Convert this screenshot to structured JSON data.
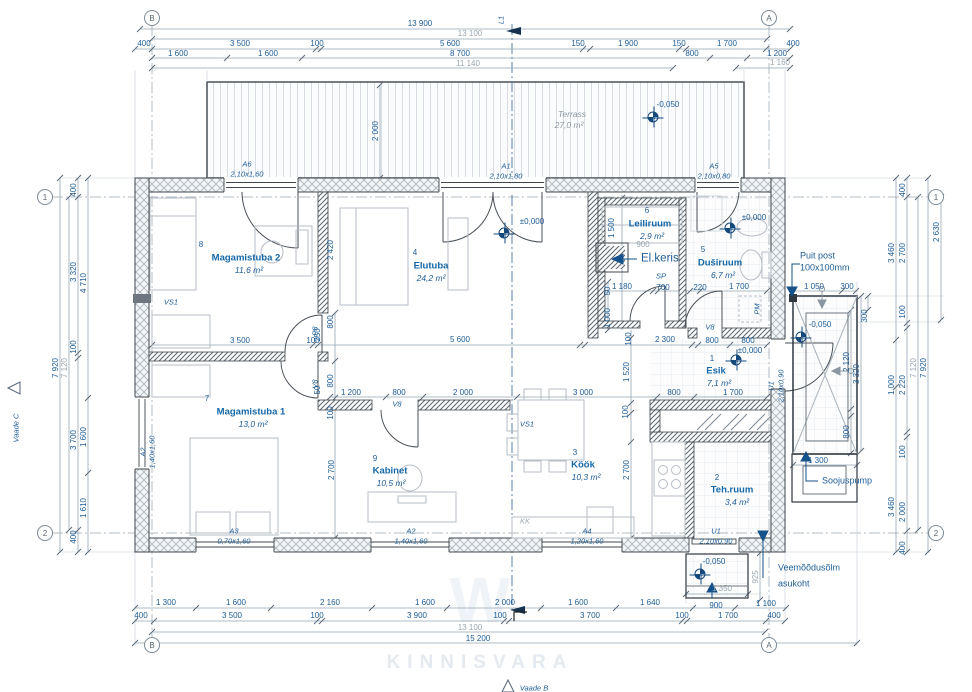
{
  "drawing": {
    "watermark": "KINNISVARA",
    "brand_mark": "W",
    "view_bottom": "Vaade B",
    "view_left": "Vaade C",
    "section_label": "L1"
  },
  "grid_markers": [
    {
      "t": "B",
      "x": 152,
      "y": 18
    },
    {
      "t": "A",
      "x": 769,
      "y": 18
    },
    {
      "t": "B",
      "x": 152,
      "y": 645
    },
    {
      "t": "A",
      "x": 769,
      "y": 645
    },
    {
      "t": "1",
      "x": 45,
      "y": 197
    },
    {
      "t": "2",
      "x": 45,
      "y": 533
    },
    {
      "t": "1",
      "x": 936,
      "y": 197
    },
    {
      "t": "2",
      "x": 936,
      "y": 533
    }
  ],
  "rooms": [
    {
      "num": "",
      "g": 1,
      "name": "Terrass",
      "x": 572,
      "y": 114,
      "area": "27,0 m²",
      "ax": 569,
      "ay": 125
    },
    {
      "num": "8",
      "nx": 201,
      "ny": 245,
      "name": "Magamistuba 2",
      "x": 246,
      "y": 258,
      "area": "11,6 m²",
      "ax": 249,
      "ay": 270
    },
    {
      "num": "4",
      "nx": 415,
      "ny": 253,
      "name": "Elutuba",
      "x": 431,
      "y": 266,
      "area": "24,2 m²",
      "ax": 431,
      "ay": 278
    },
    {
      "num": "6",
      "nx": 647,
      "ny": 211,
      "name": "Leiliruum",
      "x": 650,
      "y": 224,
      "area": "2,9 m²",
      "ax": 652,
      "ay": 236
    },
    {
      "num": "5",
      "nx": 703,
      "ny": 250,
      "name": "Duširuum",
      "x": 720,
      "y": 263,
      "area": "6,7 m²",
      "ax": 723,
      "ay": 275
    },
    {
      "num": "1",
      "nx": 712,
      "ny": 359,
      "name": "Esik",
      "x": 716,
      "y": 371,
      "area": "7,1 m²",
      "ax": 719,
      "ay": 383
    },
    {
      "num": "7",
      "nx": 207,
      "ny": 399,
      "name": "Magamistuba 1",
      "x": 251,
      "y": 412,
      "area": "13,0 m²",
      "ax": 253,
      "ay": 424
    },
    {
      "num": "9",
      "nx": 375,
      "ny": 459,
      "name": "Kabinet",
      "x": 390,
      "y": 471,
      "area": "10,5 m²",
      "ax": 391,
      "ay": 483
    },
    {
      "num": "3",
      "nx": 575,
      "ny": 453,
      "name": "Köök",
      "x": 583,
      "y": 465,
      "area": "10,3 m²",
      "ax": 586,
      "ay": 477
    },
    {
      "num": "2",
      "nx": 717,
      "ny": 478,
      "name": "Teh.ruum",
      "x": 732,
      "y": 490,
      "area": "3,4 m²",
      "ax": 737,
      "ay": 502
    }
  ],
  "openings": [
    {
      "code": "A6",
      "cx": 247,
      "cy": 164,
      "size": "2,10x1,60",
      "sx": 247,
      "sy": 174
    },
    {
      "code": "A1",
      "cx": 506,
      "cy": 166,
      "size": "2,10x1,80",
      "sx": 506,
      "sy": 176
    },
    {
      "code": "A5",
      "cx": 714,
      "cy": 166,
      "size": "2,10x0,80",
      "sx": 714,
      "sy": 176
    },
    {
      "code": "A3",
      "cx": 234,
      "cy": 531,
      "size": "0,70x1,60",
      "sx": 234,
      "sy": 541
    },
    {
      "code": "A2",
      "cx": 411,
      "cy": 531,
      "size": "1,40x1,60",
      "sx": 411,
      "sy": 541
    },
    {
      "code": "A4",
      "cx": 587,
      "cy": 531,
      "size": "1,20x1,60",
      "sx": 587,
      "sy": 541
    },
    {
      "code": "U1",
      "cx": 716,
      "cy": 531,
      "size": "2,10x0,90",
      "sx": 716,
      "sy": 541
    },
    {
      "code": "U1",
      "cx": 771,
      "cy": 386,
      "size": "2,10x0,90",
      "sx": 781,
      "sy": 386,
      "rot": 1
    },
    {
      "code": "A2",
      "cx": 143,
      "cy": 452,
      "size": "1,40x1,60",
      "sx": 152,
      "sy": 452,
      "rot": 1
    }
  ],
  "tags": [
    {
      "t": "P8",
      "x": 315,
      "y": 331,
      "rot": 1
    },
    {
      "t": "V8",
      "x": 315,
      "y": 384,
      "rot": 1
    },
    {
      "t": "V8",
      "x": 397,
      "y": 404
    },
    {
      "t": "V8",
      "x": 710,
      "y": 327
    },
    {
      "t": "SP",
      "x": 661,
      "y": 276
    },
    {
      "t": "VS1",
      "x": 171,
      "y": 302
    },
    {
      "t": "VS1",
      "x": 527,
      "y": 424
    },
    {
      "t": "PM",
      "x": 757,
      "y": 309,
      "rot": 1
    },
    {
      "t": "KK",
      "x": 525,
      "y": 521,
      "m": 1
    },
    {
      "t": "L1",
      "x": 501,
      "y": 20,
      "rot": 1
    }
  ],
  "levels": [
    {
      "t": "-0,050",
      "x": 668,
      "y": 105,
      "mx": 653,
      "my": 117
    },
    {
      "t": "±0,000",
      "x": 532,
      "y": 222,
      "mx": 504,
      "my": 233
    },
    {
      "t": "±0,000",
      "x": 754,
      "y": 218,
      "mx": 730,
      "my": 228
    },
    {
      "t": "±0,000",
      "x": 750,
      "y": 351,
      "mx": 736,
      "my": 360
    },
    {
      "t": "-0,050",
      "x": 820,
      "y": 325,
      "mx": 801,
      "my": 337
    },
    {
      "t": "-0,050",
      "x": 714,
      "y": 562,
      "mx": 700,
      "my": 574
    }
  ],
  "notes": [
    {
      "t": "Puit post",
      "x": 800,
      "y": 256
    },
    {
      "t": "100x100mm",
      "x": 800,
      "y": 268
    },
    {
      "t": "El.keris",
      "x": 641,
      "y": 259,
      "big": 1
    },
    {
      "t": "Soojuspump",
      "x": 822,
      "y": 481
    },
    {
      "t": "Veemõõdusõlm",
      "x": 778,
      "y": 568
    },
    {
      "t": "asukoht",
      "x": 778,
      "y": 584
    }
  ],
  "dims": [
    {
      "t": "13 900",
      "x": 420,
      "y": 24
    },
    {
      "t": "13 100",
      "x": 470,
      "y": 34,
      "m": 1
    },
    {
      "t": "400",
      "x": 144,
      "y": 44
    },
    {
      "t": "3 500",
      "x": 240,
      "y": 44
    },
    {
      "t": "100",
      "x": 317,
      "y": 44
    },
    {
      "t": "5 600",
      "x": 450,
      "y": 44
    },
    {
      "t": "150",
      "x": 578,
      "y": 44
    },
    {
      "t": "1 900",
      "x": 628,
      "y": 44
    },
    {
      "t": "150",
      "x": 679,
      "y": 44
    },
    {
      "t": "1 700",
      "x": 727,
      "y": 44
    },
    {
      "t": "400",
      "x": 793,
      "y": 44
    },
    {
      "t": "1 600",
      "x": 178,
      "y": 54
    },
    {
      "t": "1 600",
      "x": 268,
      "y": 54
    },
    {
      "t": "8 700",
      "x": 460,
      "y": 54
    },
    {
      "t": "800",
      "x": 692,
      "y": 54
    },
    {
      "t": "1 200",
      "x": 777,
      "y": 54
    },
    {
      "t": "11 140",
      "x": 468,
      "y": 64,
      "m": 1
    },
    {
      "t": "1 160",
      "x": 780,
      "y": 63,
      "m": 1
    },
    {
      "t": "1 300",
      "x": 166,
      "y": 603
    },
    {
      "t": "1 600",
      "x": 236,
      "y": 603
    },
    {
      "t": "2 160",
      "x": 330,
      "y": 603
    },
    {
      "t": "1 600",
      "x": 425,
      "y": 603
    },
    {
      "t": "2 000",
      "x": 505,
      "y": 603
    },
    {
      "t": "1 600",
      "x": 578,
      "y": 603
    },
    {
      "t": "1 640",
      "x": 650,
      "y": 603
    },
    {
      "t": "1 350",
      "x": 722,
      "y": 589,
      "m": 1
    },
    {
      "t": "900",
      "x": 716,
      "y": 606
    },
    {
      "t": "1 100",
      "x": 766,
      "y": 604
    },
    {
      "t": "400",
      "x": 141,
      "y": 616
    },
    {
      "t": "3 500",
      "x": 232,
      "y": 616
    },
    {
      "t": "100",
      "x": 317,
      "y": 616
    },
    {
      "t": "3 900",
      "x": 417,
      "y": 616
    },
    {
      "t": "100",
      "x": 500,
      "y": 616
    },
    {
      "t": "3 700",
      "x": 590,
      "y": 616
    },
    {
      "t": "100",
      "x": 682,
      "y": 616
    },
    {
      "t": "1 700",
      "x": 728,
      "y": 616
    },
    {
      "t": "400",
      "x": 774,
      "y": 616
    },
    {
      "t": "13 100",
      "x": 470,
      "y": 628,
      "m": 1
    },
    {
      "t": "15 200",
      "x": 478,
      "y": 639
    },
    {
      "t": "7 920",
      "x": 56,
      "y": 368,
      "r": 1
    },
    {
      "t": "7 120",
      "x": 65,
      "y": 368,
      "r": 1,
      "m": 1
    },
    {
      "t": "400",
      "x": 74,
      "y": 190,
      "r": 1
    },
    {
      "t": "3 320",
      "x": 74,
      "y": 272,
      "r": 1
    },
    {
      "t": "100",
      "x": 74,
      "y": 347,
      "r": 1
    },
    {
      "t": "3 700",
      "x": 74,
      "y": 440,
      "r": 1
    },
    {
      "t": "400",
      "x": 74,
      "y": 537,
      "r": 1
    },
    {
      "t": "4 710",
      "x": 84,
      "y": 283,
      "r": 1
    },
    {
      "t": "1 600",
      "x": 84,
      "y": 437,
      "r": 1
    },
    {
      "t": "1 610",
      "x": 84,
      "y": 508,
      "r": 1
    },
    {
      "t": "3 460",
      "x": 892,
      "y": 253,
      "r": 1
    },
    {
      "t": "1 000",
      "x": 892,
      "y": 385,
      "r": 1
    },
    {
      "t": "3 460",
      "x": 892,
      "y": 507,
      "r": 1
    },
    {
      "t": "400",
      "x": 903,
      "y": 190,
      "r": 1
    },
    {
      "t": "2 700",
      "x": 903,
      "y": 253,
      "r": 1
    },
    {
      "t": "100",
      "x": 903,
      "y": 312,
      "r": 1
    },
    {
      "t": "2 220",
      "x": 903,
      "y": 385,
      "r": 1
    },
    {
      "t": "100",
      "x": 903,
      "y": 452,
      "r": 1
    },
    {
      "t": "2 000",
      "x": 903,
      "y": 512,
      "r": 1
    },
    {
      "t": "400",
      "x": 903,
      "y": 548,
      "r": 1
    },
    {
      "t": "7 120",
      "x": 914,
      "y": 368,
      "r": 1,
      "m": 1
    },
    {
      "t": "7 920",
      "x": 924,
      "y": 368,
      "r": 1
    },
    {
      "t": "2 630",
      "x": 937,
      "y": 232,
      "r": 1
    },
    {
      "t": "1 050",
      "x": 814,
      "y": 287
    },
    {
      "t": "300",
      "x": 847,
      "y": 287
    },
    {
      "t": "300",
      "x": 865,
      "y": 316,
      "r": 1
    },
    {
      "t": "2 120",
      "x": 847,
      "y": 362,
      "r": 1
    },
    {
      "t": "3 320",
      "x": 857,
      "y": 374,
      "r": 1
    },
    {
      "t": "800",
      "x": 847,
      "y": 432,
      "r": 1
    },
    {
      "t": "1 300",
      "x": 818,
      "y": 461
    },
    {
      "t": "925",
      "x": 756,
      "y": 577,
      "r": 1,
      "m": 1
    },
    {
      "t": "2 000",
      "x": 376,
      "y": 131,
      "r": 1
    },
    {
      "t": "2 420",
      "x": 331,
      "y": 250,
      "r": 1
    },
    {
      "t": "3 500",
      "x": 240,
      "y": 341
    },
    {
      "t": "100",
      "x": 313,
      "y": 341
    },
    {
      "t": "5 600",
      "x": 460,
      "y": 340
    },
    {
      "t": "100",
      "x": 629,
      "y": 339,
      "r": 1
    },
    {
      "t": "2 300",
      "x": 665,
      "y": 340
    },
    {
      "t": "800",
      "x": 712,
      "y": 341
    },
    {
      "t": "800",
      "x": 748,
      "y": 341
    },
    {
      "t": "250",
      "x": 318,
      "y": 335,
      "r": 1
    },
    {
      "t": "800",
      "x": 331,
      "y": 322,
      "r": 1
    },
    {
      "t": "50",
      "x": 318,
      "y": 390,
      "r": 1
    },
    {
      "t": "800",
      "x": 331,
      "y": 381,
      "r": 1
    },
    {
      "t": "100",
      "x": 331,
      "y": 413,
      "r": 1
    },
    {
      "t": "2 700",
      "x": 332,
      "y": 470,
      "r": 1
    },
    {
      "t": "1 200",
      "x": 351,
      "y": 393
    },
    {
      "t": "800",
      "x": 399,
      "y": 393
    },
    {
      "t": "2 000",
      "x": 463,
      "y": 393
    },
    {
      "t": "3 000",
      "x": 583,
      "y": 393
    },
    {
      "t": "800",
      "x": 674,
      "y": 393
    },
    {
      "t": "1 700",
      "x": 733,
      "y": 393
    },
    {
      "t": "100",
      "x": 626,
      "y": 412,
      "r": 1
    },
    {
      "t": "2 700",
      "x": 627,
      "y": 470,
      "r": 1
    },
    {
      "t": "1 520",
      "x": 627,
      "y": 372,
      "r": 1
    },
    {
      "t": "1 500",
      "x": 612,
      "y": 228,
      "r": 1
    },
    {
      "t": "900",
      "x": 643,
      "y": 245,
      "m": 1
    },
    {
      "t": "1 180",
      "x": 622,
      "y": 287
    },
    {
      "t": "700",
      "x": 663,
      "y": 288
    },
    {
      "t": "220",
      "x": 700,
      "y": 288
    },
    {
      "t": "1 700",
      "x": 739,
      "y": 287
    },
    {
      "t": "1 000",
      "x": 608,
      "y": 318,
      "r": 1
    },
    {
      "t": "50",
      "x": 608,
      "y": 291,
      "r": 1
    }
  ]
}
